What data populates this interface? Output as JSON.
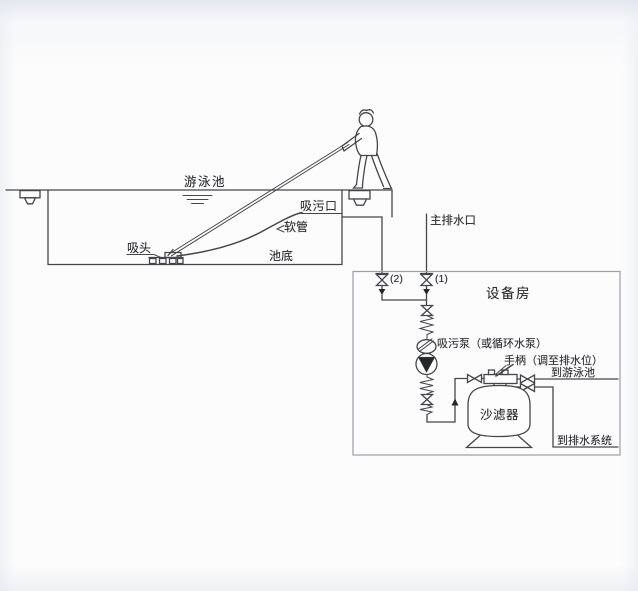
{
  "colors": {
    "line": "#44464b",
    "box_border": "#9aa0a8",
    "text": "#2c2d31",
    "symbol_fill": "#26272b",
    "background": "#fcfcfd"
  },
  "pool": {
    "title": "游泳池",
    "suction_port": "吸污口",
    "hose": "软管",
    "suction_head": "吸头",
    "pool_bottom": "池底"
  },
  "piping": {
    "main_drain": "主排水口",
    "valve_2": "(2)",
    "valve_1": "(1)"
  },
  "equipment_room": {
    "title": "设备房",
    "pump": "吸污泵（或循环水泵）",
    "handle": "手柄（调至排水位）",
    "to_pool": "到游泳池",
    "sand_filter": "沙滤器",
    "to_drain_system": "到排水系统"
  }
}
